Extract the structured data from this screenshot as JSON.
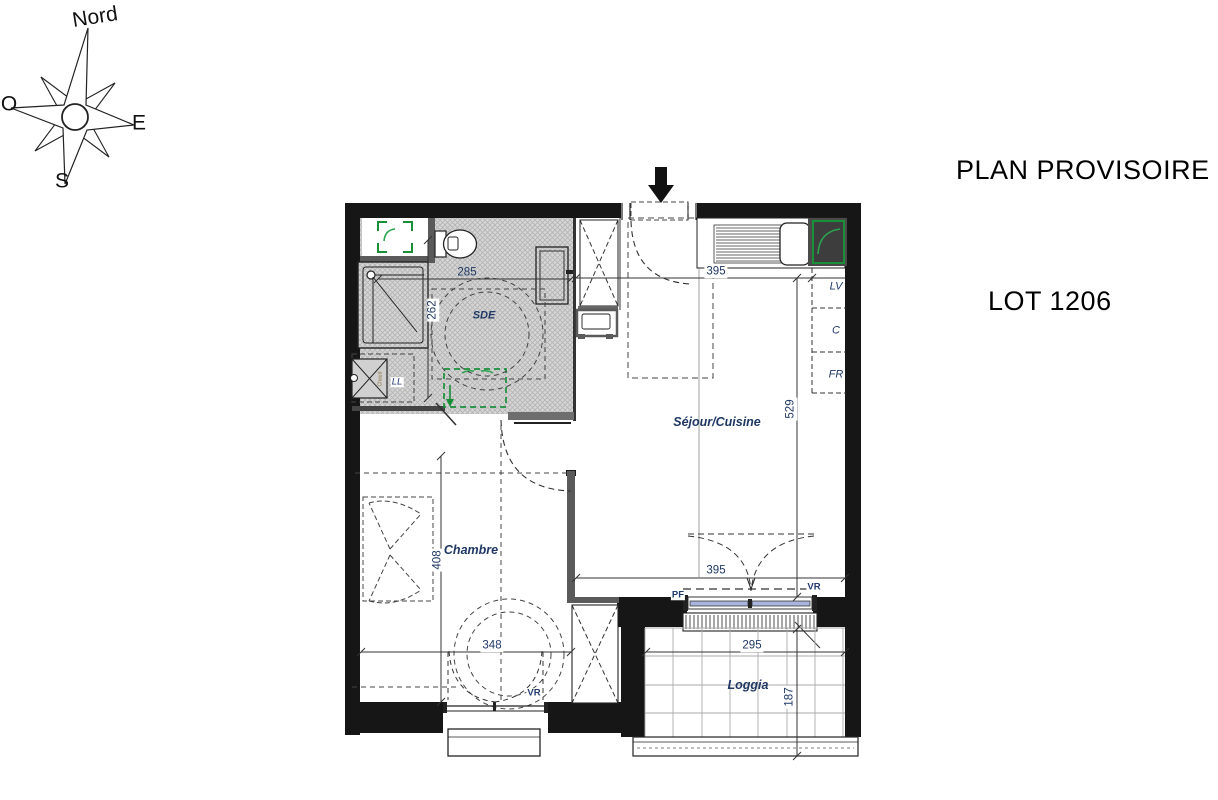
{
  "header": {
    "plan_status": "PLAN PROVISOIRE",
    "lot": "LOT 1206"
  },
  "compass": {
    "north": "Nord",
    "west": "O",
    "east": "E",
    "south": "S"
  },
  "rooms": {
    "bathroom": "SDE",
    "living": "Séjour/Cuisine",
    "bedroom": "Chambre",
    "loggia": "Loggia"
  },
  "appliances": {
    "dishwasher": "LV",
    "cupboard": "C",
    "fridge": "FR",
    "washer": "LL",
    "water_heater": "Chaud"
  },
  "openings": {
    "loggia_window": "PF",
    "loggia_shutter": "VR",
    "bedroom_shutter": "VR"
  },
  "dimensions": {
    "bathroom_width": "285",
    "bathroom_depth": "262",
    "living_width_top": "395",
    "living_width_bottom": "395",
    "living_depth": "529",
    "bedroom_width": "348",
    "bedroom_depth": "408",
    "loggia_width": "295",
    "loggia_depth": "187"
  },
  "colors": {
    "wall_black": "#161616",
    "partition_gray": "#5a5a5a",
    "accent_green": "#1a8f3a",
    "label_blue": "#1f3864",
    "glazing_blue": "#a9b5dc"
  }
}
